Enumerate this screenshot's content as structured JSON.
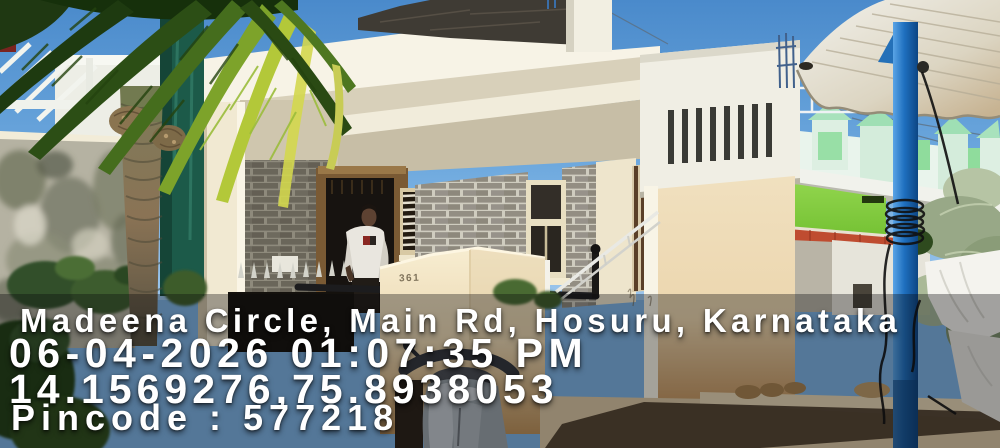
{
  "overlay": {
    "location": "Madeena Circle, Main Rd, Hosuru, Karnataka",
    "datetime": "06-04-2026 01:07:35 PM",
    "coordinates": "14.1569276,75.8938053",
    "pincode": "Pincode : 577218"
  },
  "scene": {
    "house_number": "361",
    "description": "Cream single-storey house with grey stone-clad porch wall, man in white t-shirt standing in dark doorway, palm tree at left, mint-green crenellated building and blue metal pole at right, corrugated awning top-right, scooter and sandy ground in foreground",
    "palette": {
      "sky": "#5795d2",
      "house_cream": "#f1e7cf",
      "stone_grey": "#938e83",
      "green_building": "#82cf3e",
      "pole_blue": "#1d6fc0",
      "awning": "#ddd6c6",
      "watermark_text": "#ffffff",
      "watermark_band": "rgba(8,9,11,0.35)"
    }
  }
}
